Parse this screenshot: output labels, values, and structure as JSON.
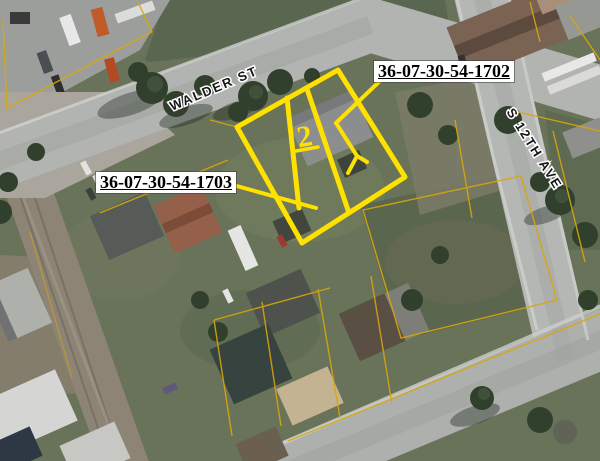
{
  "map": {
    "streets": [
      {
        "name": "WALDER ST"
      },
      {
        "name": "S 12TH AVE"
      }
    ],
    "parcels": [
      {
        "id": "36-07-30-54-1702"
      },
      {
        "id": "36-07-30-54-1703"
      }
    ],
    "annotation_marker": "2",
    "colors": {
      "highlight_yellow": "#ffe100",
      "parcel_line_orange": "#d9a60a",
      "road_gray": "#b2b4b1",
      "grass_green": "#68735a",
      "label_background": "#ffffff",
      "label_text": "#000000",
      "street_label_halo": "#ffffff"
    }
  }
}
